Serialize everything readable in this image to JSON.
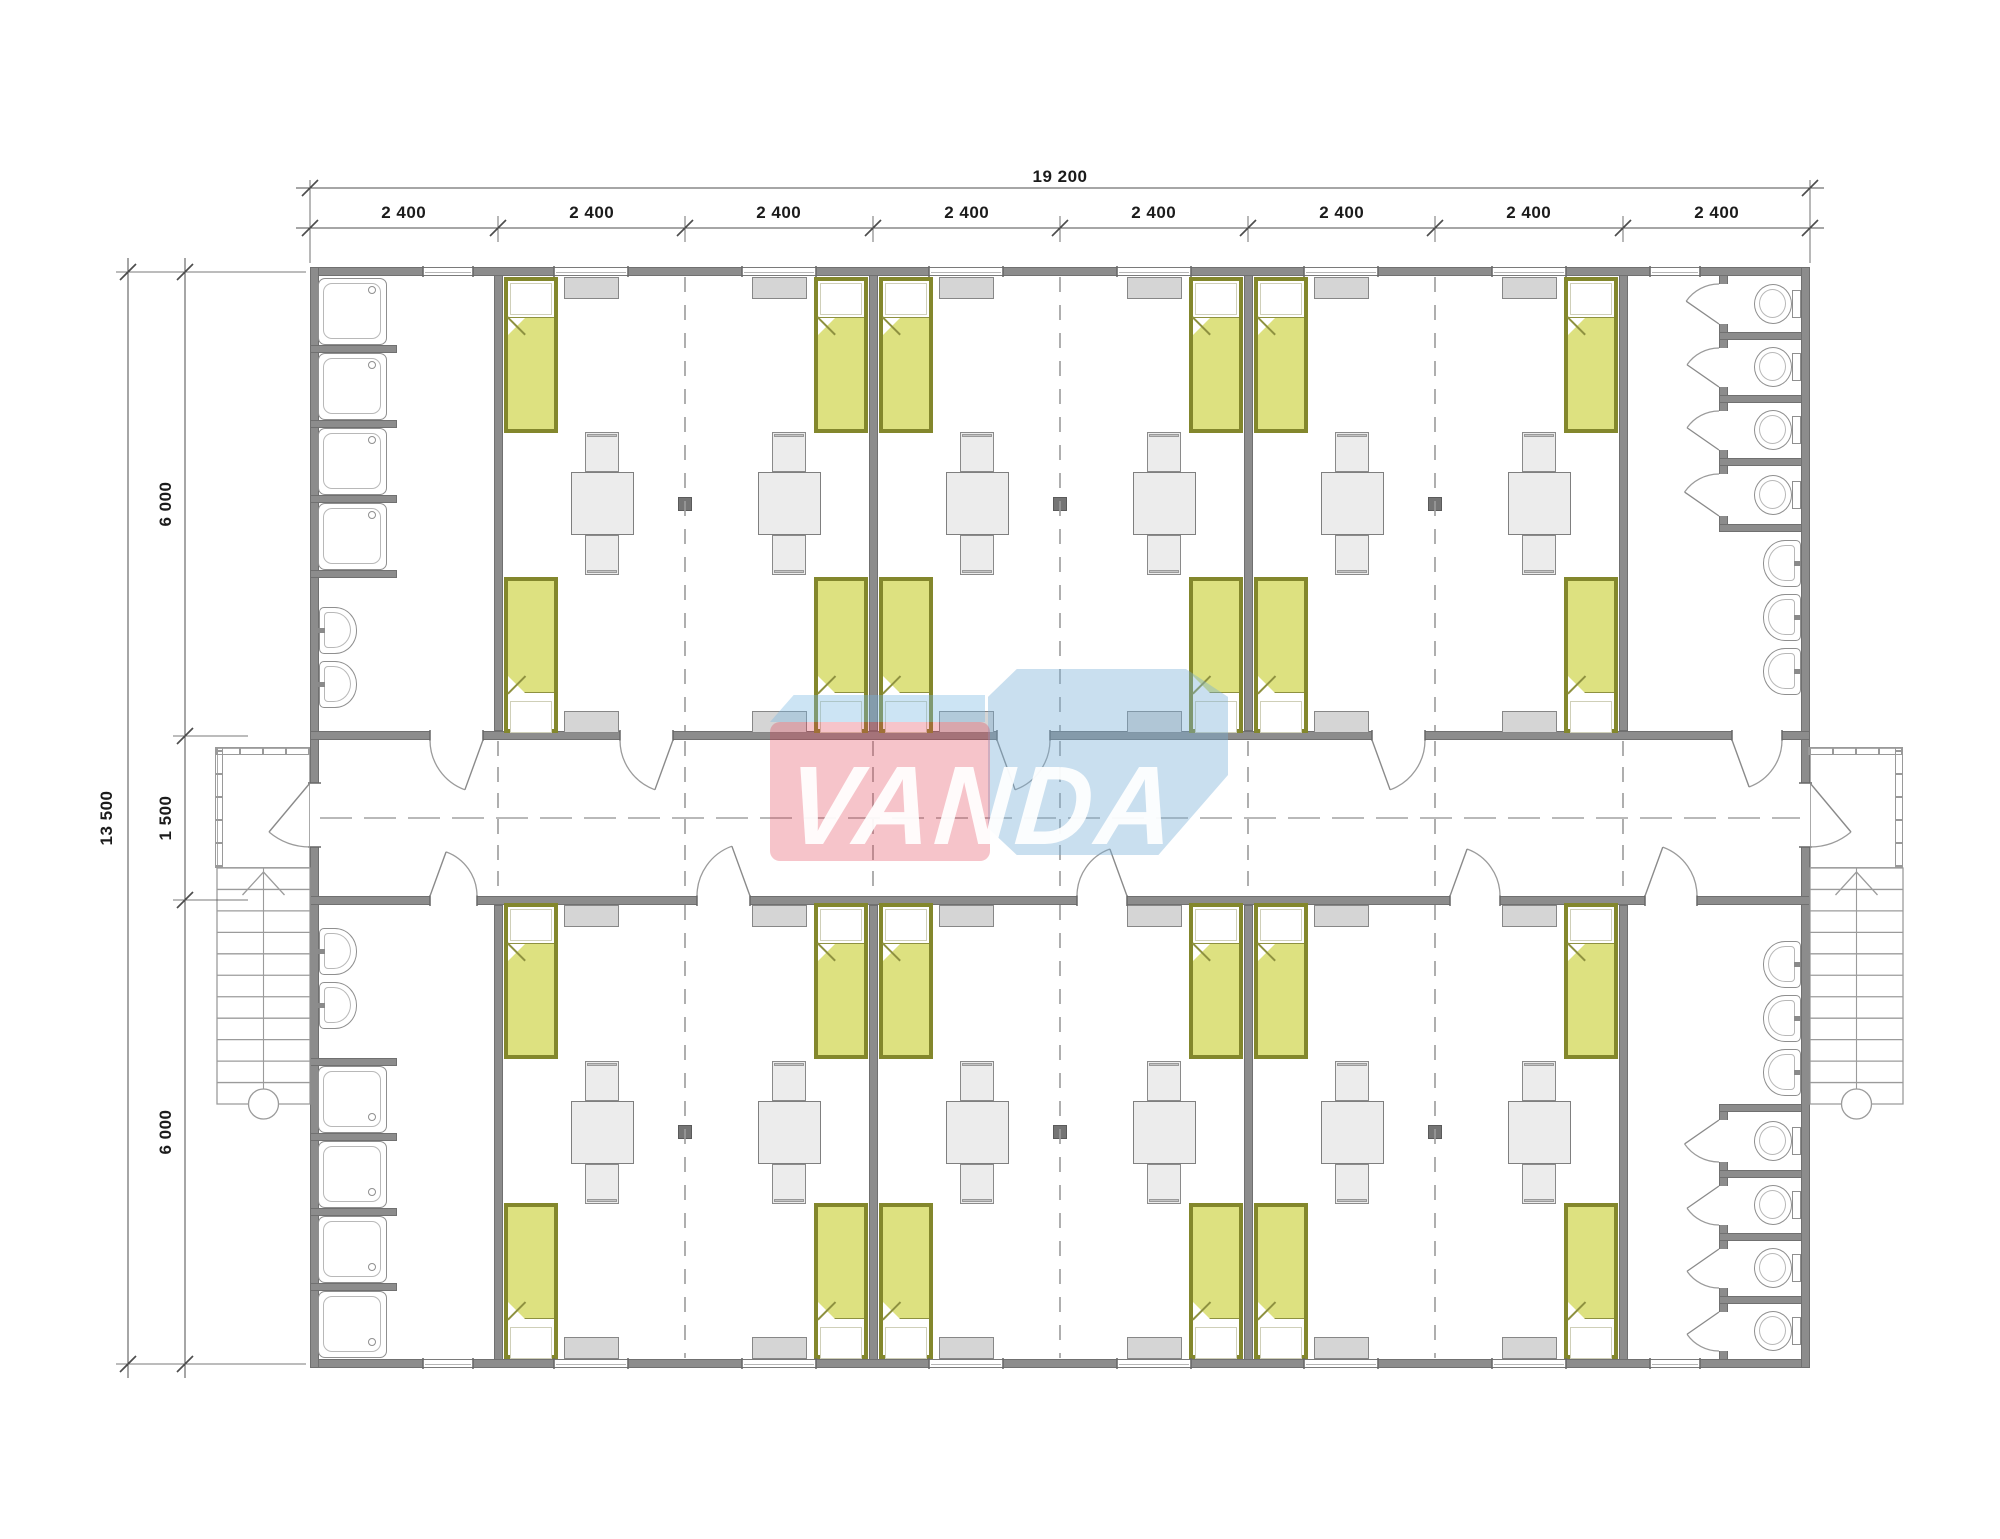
{
  "dimensions": {
    "overall_width": "19 200",
    "modules": [
      "2 400",
      "2 400",
      "2 400",
      "2 400",
      "2 400",
      "2 400",
      "2 400",
      "2 400"
    ],
    "overall_height": "13 500",
    "height_segments": [
      "6 000",
      "1 500",
      "6 000"
    ]
  },
  "watermark": {
    "text": "VANDA"
  },
  "colors": {
    "wall": "#8c8c8c",
    "wall_edge": "#707070",
    "bed_blanket": "#dde180",
    "bed_frame": "#83872c",
    "bed_fold_line": "#8e9140",
    "pillow": "#ffffff",
    "furniture": "#ececec",
    "furniture_edge": "#7f7f7f",
    "cabinet": "#d5d5d5",
    "cabinet_edge": "#878787",
    "fixture_line": "#8f8f8f",
    "thin_line": "#9b9b9b",
    "dim_line": "#4d4d4d",
    "column": "#757575",
    "wm_red": "rgba(226,60,80,0.30)",
    "wm_blue": "rgba(120,175,215,0.40)",
    "wm_blue_light": "rgba(120,185,225,0.38)"
  },
  "inventory": {
    "rooms": 6,
    "beds_per_room": 4,
    "cabinets_per_room": 4,
    "tables_per_room": 2,
    "chairs_per_table": 2,
    "bathrooms": [
      {
        "id": "top-left",
        "showers": 4,
        "sinks": 2
      },
      {
        "id": "bottom-left",
        "showers": 4,
        "sinks": 2
      },
      {
        "id": "top-right",
        "toilets": 4,
        "sinks": 3
      },
      {
        "id": "bottom-right",
        "toilets": 4,
        "sinks": 3
      }
    ],
    "staircases": 2,
    "entrance_doors": 2,
    "interior_doors": 10
  }
}
